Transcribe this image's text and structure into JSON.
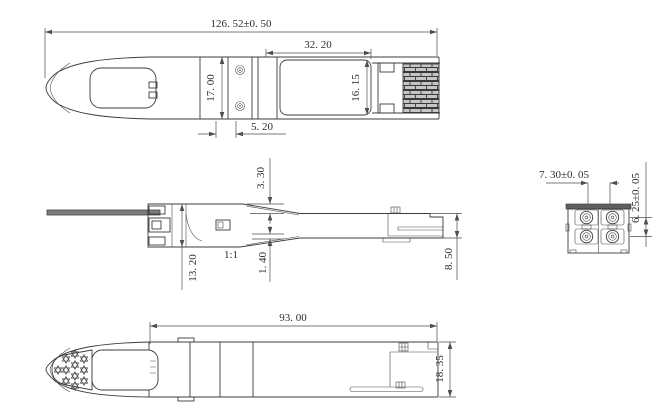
{
  "drawing": {
    "scale_note": "1:1",
    "dims": {
      "overall_length": "126. 52±0. 50",
      "rear_recess_length": "32. 20",
      "body_height": "17. 00",
      "recess_height": "16. 15",
      "plate_width": "5. 20",
      "top_step": "3. 30",
      "front_height": "13. 20",
      "bottom_step": "1. 40",
      "rear_height": "8. 50",
      "port_h_pitch": "7. 30±0. 05",
      "port_v_pitch": "6. 25±0. 05",
      "lower_body_length": "93. 00",
      "lower_body_width": "18. 35"
    }
  }
}
